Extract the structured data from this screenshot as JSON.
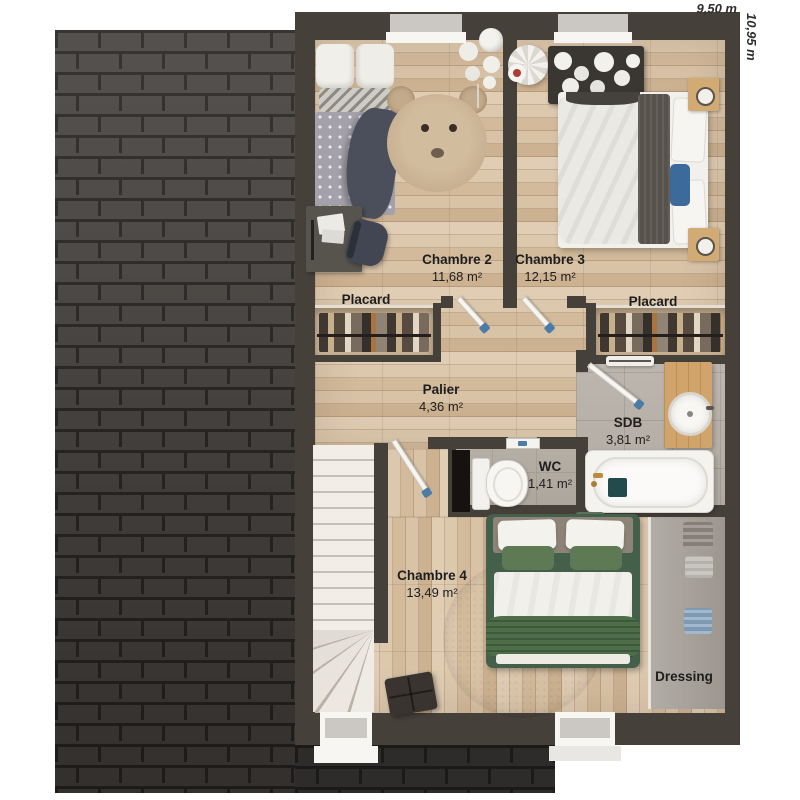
{
  "plan": {
    "title": "Plan d'étage",
    "dimensions": {
      "width": "9,50 m",
      "height": "10,95 m"
    },
    "rooms": [
      {
        "name": "Chambre 2",
        "area": "11,68 m²"
      },
      {
        "name": "Chambre 3",
        "area": "12,15 m²"
      },
      {
        "name": "Placard",
        "area": ""
      },
      {
        "name": "Placard",
        "area": ""
      },
      {
        "name": "Palier",
        "area": "4,36 m²"
      },
      {
        "name": "SDB",
        "area": "3,81 m²"
      },
      {
        "name": "WC",
        "area": "1,41 m²"
      },
      {
        "name": "Chambre 4",
        "area": "13,49 m²"
      },
      {
        "name": "Dressing",
        "area": ""
      }
    ],
    "colors": {
      "wall": "#46403a",
      "wood_floor": "#d7c1a5",
      "tile_floor": "#b8b2aa",
      "roof_brick": "#4a4643",
      "roof_mortar": "#2b2825",
      "door_handle": "#4c7ca6",
      "bed_green": "#4e6e4a",
      "pillow_blue": "#3c6a9b",
      "label_text": "#1e1e1e"
    }
  }
}
